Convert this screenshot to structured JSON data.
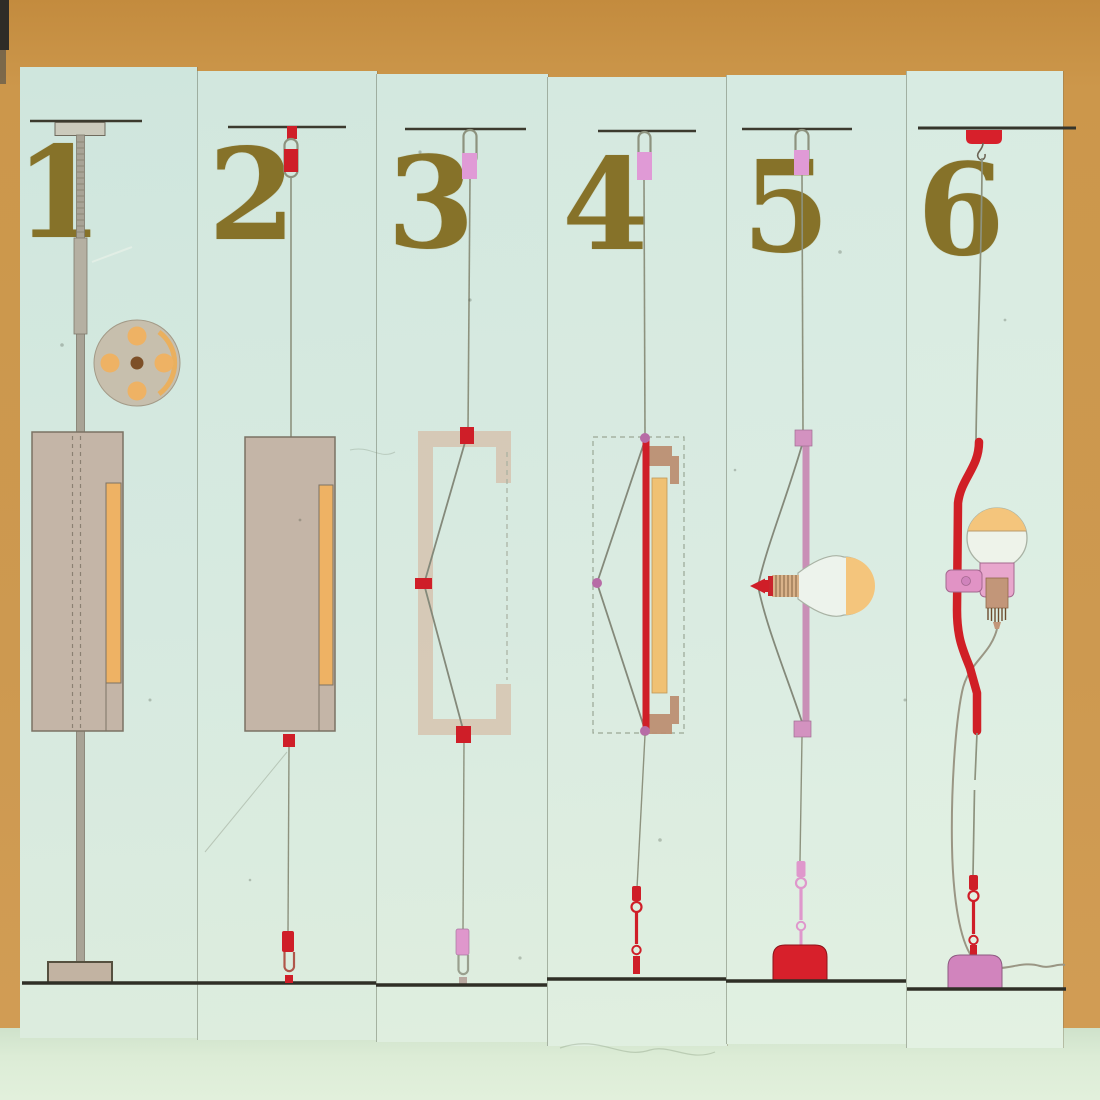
{
  "poster": {
    "title": "lamp-design-evolution-six-panel-board",
    "panels": [
      {
        "number": "1",
        "name": "floor-pole-lamp-with-base-disc"
      },
      {
        "number": "2",
        "name": "ceiling-hung-counterweight-lamp"
      },
      {
        "number": "3",
        "name": "c-frame-cable-tension-lamp"
      },
      {
        "number": "4",
        "name": "tube-and-frame-cable-tension-lamp"
      },
      {
        "number": "5",
        "name": "bar-mounted-spotlight-tension-lamp"
      },
      {
        "number": "6",
        "name": "bent-tube-parentesi-lamp"
      }
    ],
    "colors": {
      "cardboard": "#cc974b",
      "board_mint": "#d6e9e0",
      "number_olive": "#867229",
      "line_dark": "#35352b",
      "cable_grey": "#8d927e",
      "accent_red": "#cf1e28",
      "accent_pink": "#df9ad4",
      "accent_mauve": "#c98fb6",
      "body_tan": "#c4b5a7",
      "accent_orange": "#eeb264",
      "base_violet": "#d184bd",
      "table_green": "#dcecd6"
    }
  }
}
